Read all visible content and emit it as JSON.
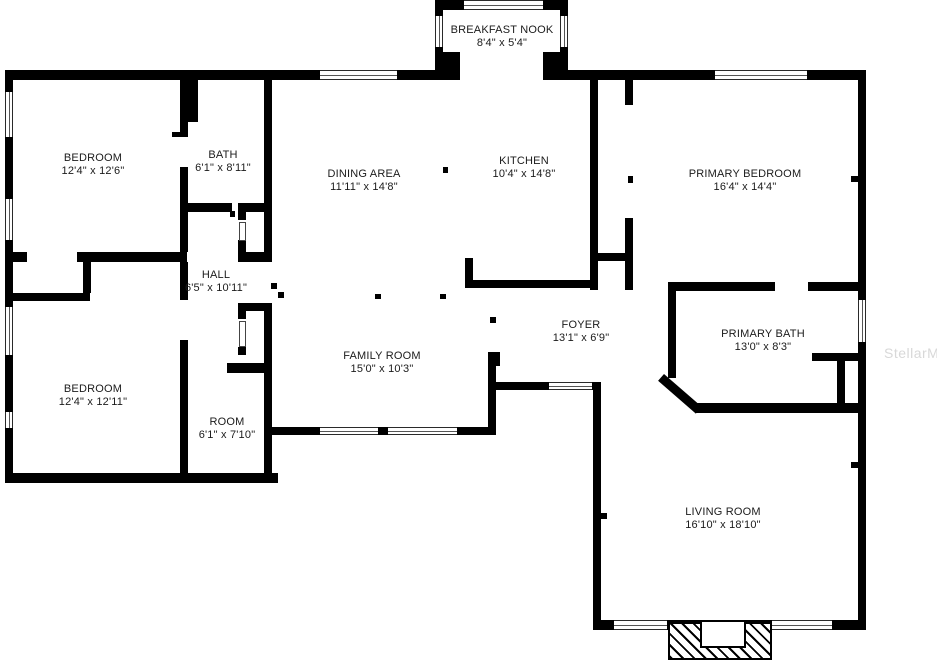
{
  "watermark": "StellarMLS",
  "colors": {
    "wall": "#000000",
    "background": "#ffffff",
    "label": "#1b1b1b",
    "watermark": "#d8d8d8"
  },
  "rooms": [
    {
      "name": "BREAKFAST NOOK",
      "dims": "8'4\" x 5'4\""
    },
    {
      "name": "BEDROOM",
      "dims": "12'4\" x 12'6\""
    },
    {
      "name": "BATH",
      "dims": "6'1\" x 8'11\""
    },
    {
      "name": "DINING AREA",
      "dims": "11'11\" x 14'8\""
    },
    {
      "name": "KITCHEN",
      "dims": "10'4\" x 14'8\""
    },
    {
      "name": "PRIMARY BEDROOM",
      "dims": "16'4\" x 14'4\""
    },
    {
      "name": "HALL",
      "dims": "6'5\" x 10'11\""
    },
    {
      "name": "FOYER",
      "dims": "13'1\" x 6'9\""
    },
    {
      "name": "PRIMARY BATH",
      "dims": "13'0\" x 8'3\""
    },
    {
      "name": "BEDROOM",
      "dims": "12'4\" x 12'11\""
    },
    {
      "name": "FAMILY ROOM",
      "dims": "15'0\" x 10'3\""
    },
    {
      "name": "ROOM",
      "dims": "6'1\" x 7'10\""
    },
    {
      "name": "LIVING ROOM",
      "dims": "16'10\" x 18'10\""
    }
  ]
}
